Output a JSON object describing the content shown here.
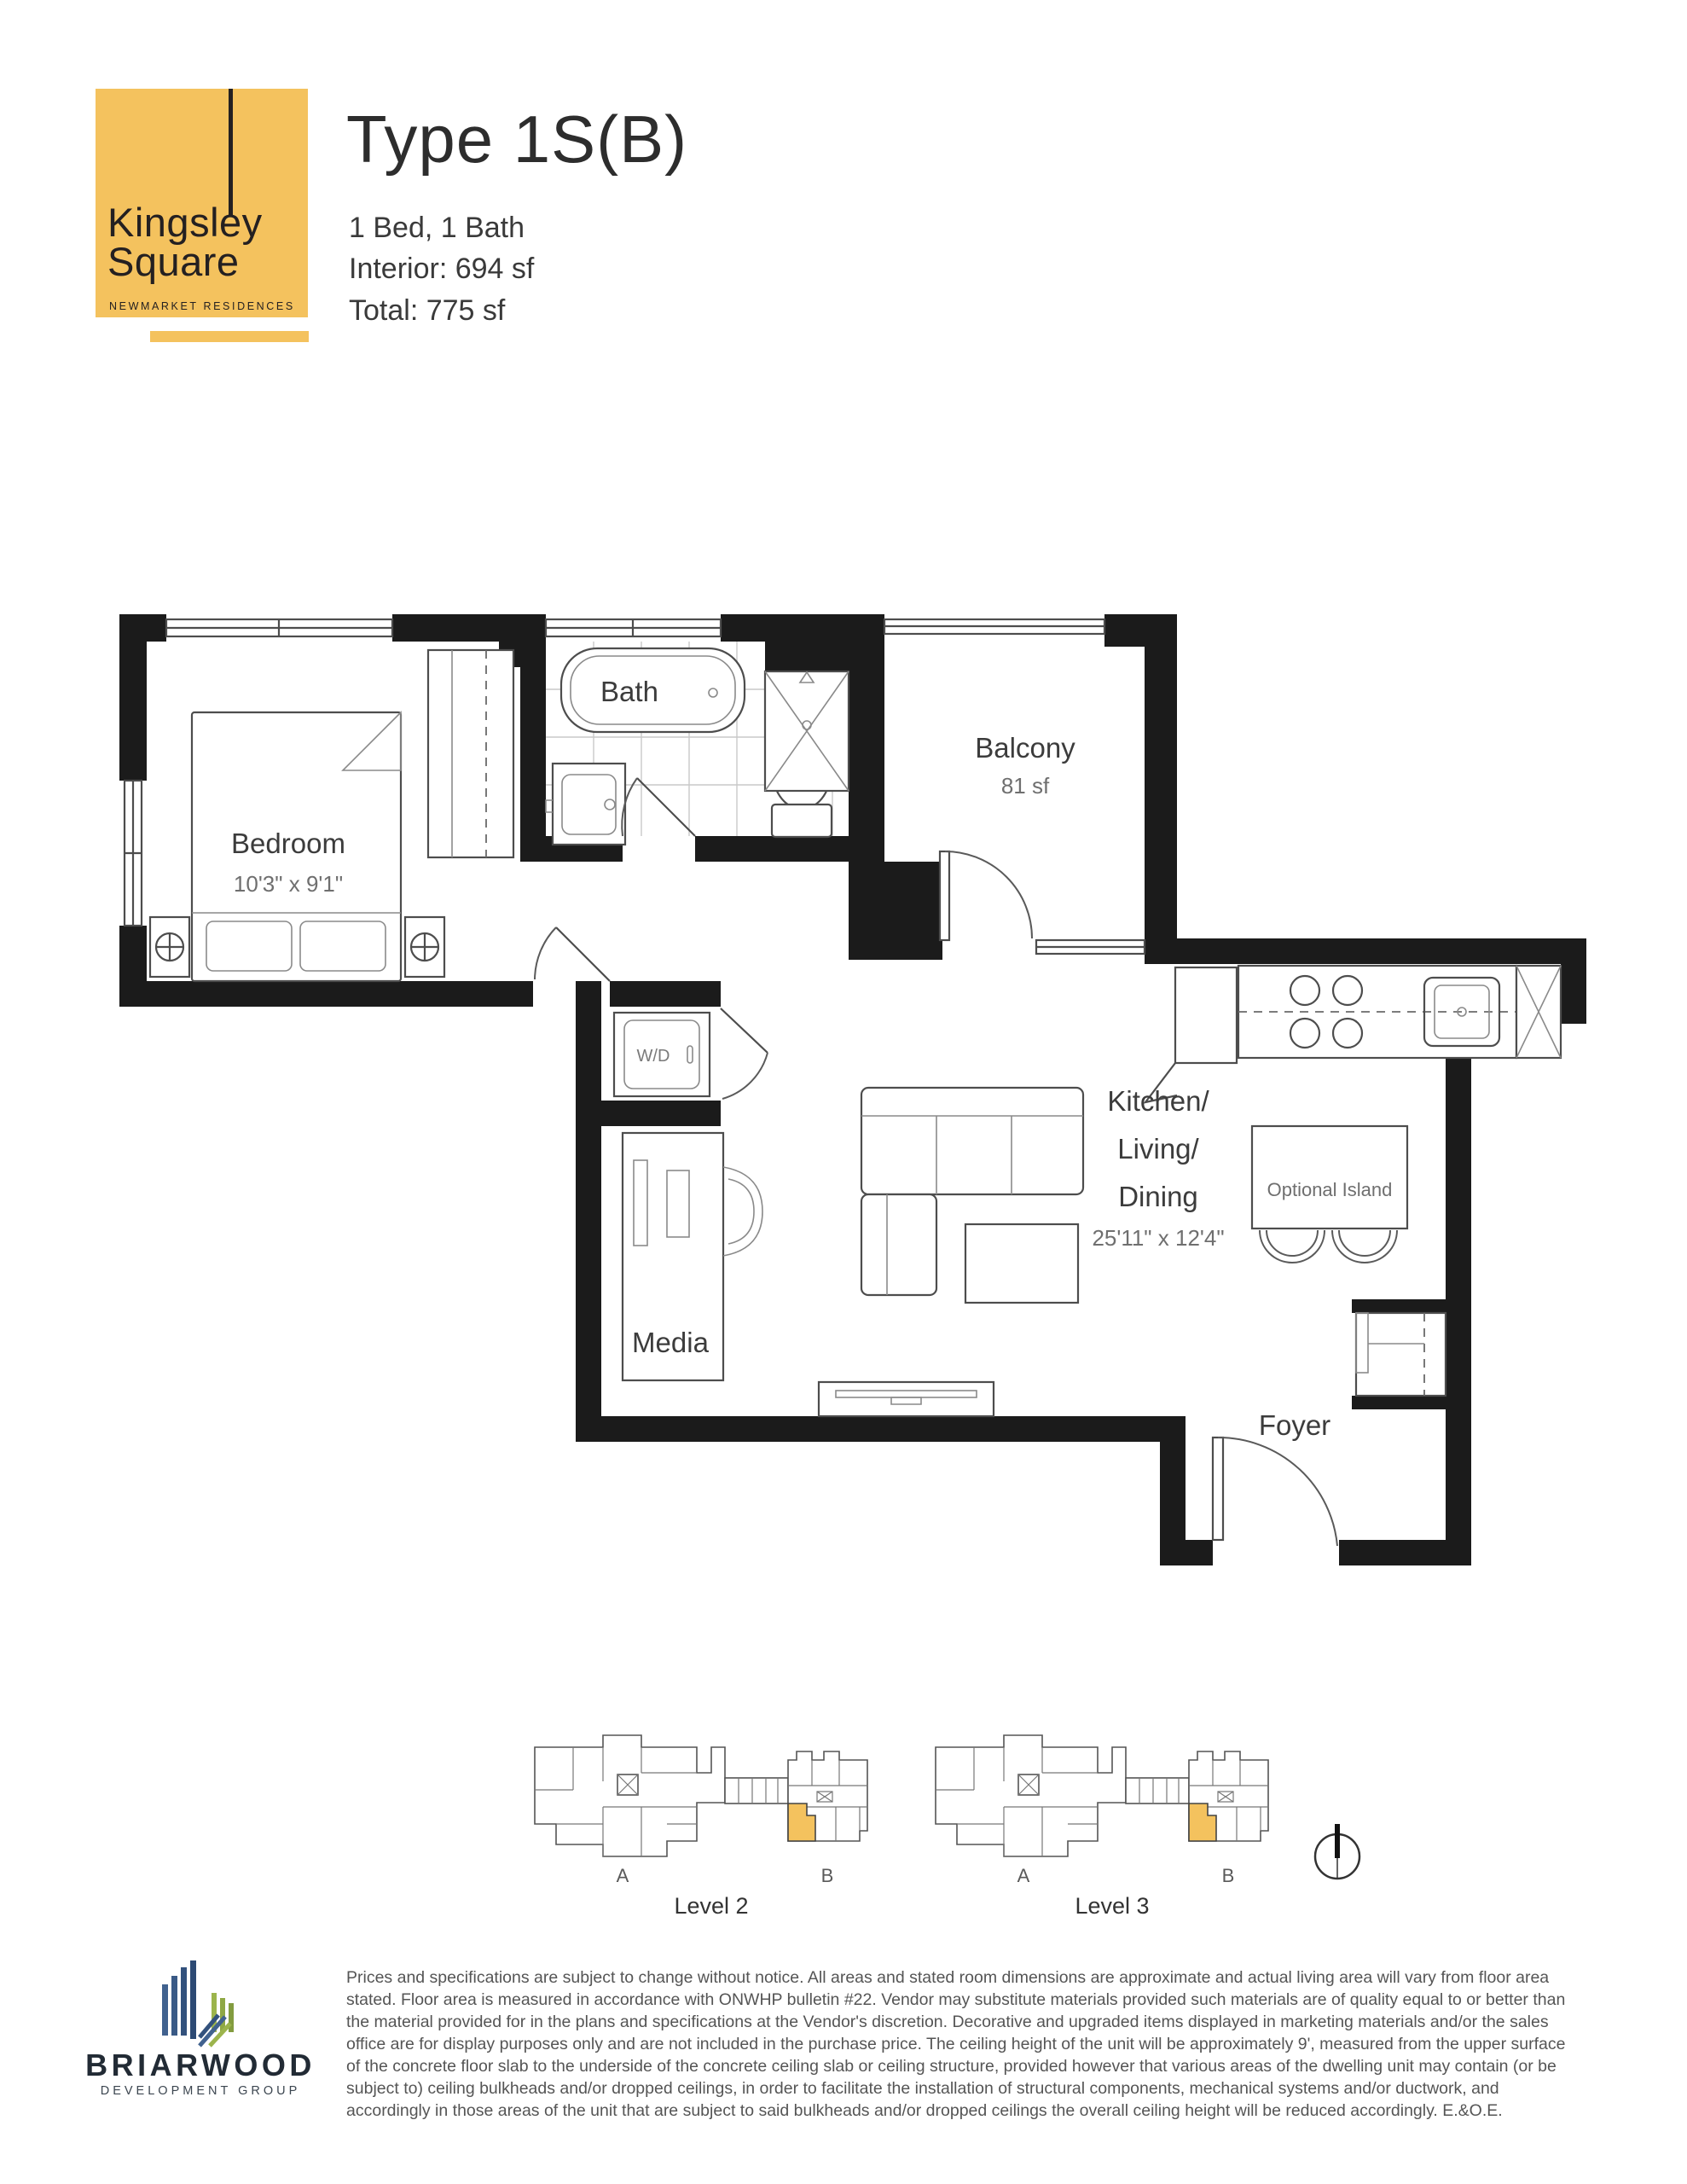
{
  "branding": {
    "logo_line1": "Kingsley",
    "logo_line2": "Square",
    "logo_tagline": "NEWMARKET RESIDENCES"
  },
  "header": {
    "title": "Type 1S(B)",
    "spec_line1": "1 Bed, 1 Bath",
    "spec_line2": "Interior: 694 sf",
    "spec_line3": "Total: 775 sf"
  },
  "plan": {
    "bedroom": {
      "label": "Bedroom",
      "dims": "10'3\" x 9'1\""
    },
    "bath": {
      "label": "Bath"
    },
    "balcony": {
      "label": "Balcony",
      "area": "81 sf"
    },
    "great_room": {
      "line1": "Kitchen/",
      "line2": "Living/",
      "line3": "Dining",
      "dims": "25'11\" x 12'4\""
    },
    "island": {
      "label": "Optional Island"
    },
    "laundry": {
      "label": "W/D"
    },
    "media": {
      "label": "Media"
    },
    "foyer": {
      "label": "Foyer"
    }
  },
  "keyplans": {
    "level2": {
      "label": "Level 2",
      "wing_a": "A",
      "wing_b": "B"
    },
    "level3": {
      "label": "Level 3",
      "wing_a": "A",
      "wing_b": "B"
    }
  },
  "footer": {
    "disclaimer": "Prices and specifications are subject to change without notice. All areas and stated room dimensions are approximate and actual living area will vary from floor area stated. Floor area is measured in accordance with ONWHP bulletin #22. Vendor may substitute materials provided such materials are of quality equal to or better than the material provided for in the plans and specifications at the Vendor's discretion. Decorative and upgraded items displayed in marketing materials and/or the sales office are for display purposes only and are not included in the purchase price. The ceiling height of the unit will be approximately 9', measured from the upper surface of the concrete floor slab to the underside of the concrete ceiling slab or ceiling structure, provided however that various areas of the dwelling unit may contain (or be subject to) ceiling bulkheads and/or dropped ceilings, in order to facilitate the installation of structural components, mechanical systems and/or ductwork, and accordingly in those areas of the unit that are subject to said bulkheads and/or dropped ceilings the overall ceiling height will be reduced accordingly. E.&O.E.",
    "brand_name": "BRIARWOOD",
    "brand_tagline": "DEVELOPMENT GROUP"
  },
  "colors": {
    "accent_yellow": "#F4C25E",
    "wall_black": "#1B1B1B",
    "line_gray": "#4D4D4D",
    "text_gray": "#58595B"
  }
}
